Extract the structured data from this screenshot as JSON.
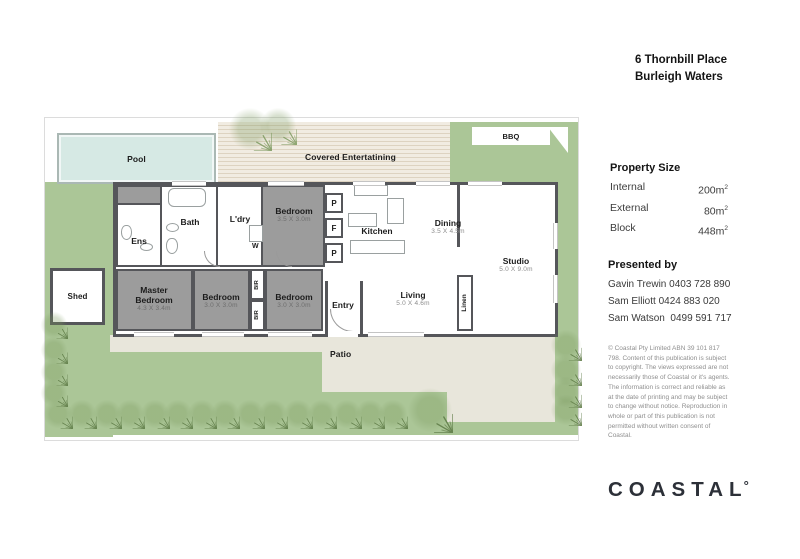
{
  "address": {
    "line1": "6 Thornbill Place",
    "line2": "Burleigh Waters"
  },
  "property_size": {
    "heading": "Property Size",
    "rows": [
      {
        "label": "Internal",
        "value": "200m",
        "sup": "2"
      },
      {
        "label": "External",
        "value": "80m",
        "sup": "2"
      },
      {
        "label": "Block",
        "value": "448m",
        "sup": "2"
      }
    ]
  },
  "presented_by": {
    "heading": "Presented by",
    "agents": [
      "Gavin Trewin 0403 728 890",
      "Sam Elliott 0424 883 020",
      "Sam Watson  0499 591 717"
    ]
  },
  "disclaimer": "© Coastal Pty Limited ABN 39 101 817 798. Content of this publication is subject to copyright. The views expressed are not necessarily those of Coastal or it's agents. The information is correct and reliable as at the date of printing and may be subject to change without notice. Reproduction in whole or part of this publication is not permitted without written consent of Coastal.",
  "logo": {
    "text": "COASTAL",
    "degree": "°"
  },
  "plan": {
    "pool": "Pool",
    "covered": "Covered Entertatining",
    "bbq": "BBQ",
    "shed": "Shed",
    "patio": "Patio",
    "rooms": {
      "ens": {
        "name": "Ens"
      },
      "bath": {
        "name": "Bath"
      },
      "ldry": {
        "name": "L'dry"
      },
      "bed2": {
        "name": "Bedroom",
        "dim": "3.5 X 3.0m"
      },
      "kitchen": {
        "name": "Kitchen"
      },
      "dining": {
        "name": "Dining",
        "dim": "3.5 X 4.5m"
      },
      "studio": {
        "name": "Studio",
        "dim": "5.0 X 9.0m"
      },
      "master": {
        "name": "Master Bedroom",
        "dim": "4.3 X 3.4m"
      },
      "bed3": {
        "name": "Bedroom",
        "dim": "3.0 X 3.0m"
      },
      "bed4": {
        "name": "Bedroom",
        "dim": "3.0 X 3.0m"
      },
      "entry": {
        "name": "Entry"
      },
      "living": {
        "name": "Living",
        "dim": "5.0 X 4.6m"
      },
      "linen": {
        "name": "Linen"
      }
    },
    "labels": {
      "bir": "BIR",
      "w": "W",
      "p": "P",
      "f": "F"
    }
  },
  "icons": {
    "tree": "tree-icon",
    "palm": "palm-icon"
  },
  "colors": {
    "lawn": "#abc697",
    "deck_light": "#f1ece2",
    "deck_line": "#ddd3c1",
    "patio": "#e8e6db",
    "pool_fill": "#d6e9e4",
    "pool_edge": "#aab8b4",
    "wall": "#55565a",
    "carpet": "#9c9c9c",
    "tree": "#5d7a45",
    "palm": "#7d9a60",
    "text_dark": "#1c1c1c",
    "dim_text": "#8c8c8c",
    "logo": "#2c3038",
    "disclaimer_text": "#8f8f8f"
  }
}
